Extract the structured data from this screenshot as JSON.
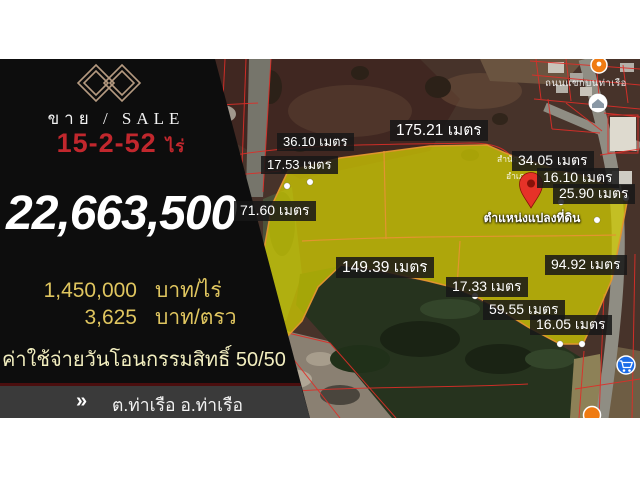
{
  "title": "Land for sale listing — Tha Ruea, Ayutthaya",
  "panel": {
    "logo_icon": "double-diamond-logo",
    "sale_line": "ขาย / SALE",
    "area_value": "15-2-52",
    "area_unit": "ไร่",
    "total_price": "22,663,500",
    "price_rows": [
      {
        "value": "1,450,000",
        "unit": "บาท/ไร่"
      },
      {
        "value": "3,625",
        "unit": "บาท/ตรว"
      }
    ],
    "transfer_note": "ค่าใช้จ่ายวันโอนกรรมสิทธิ์ 50/50",
    "location_chevron": "»",
    "location": "ต.ท่าเรือ อ.ท่าเรือ จ.อยุธยา",
    "colors": {
      "accent_red": "#c1272d",
      "gold": "#dfc55f",
      "pale_yellow": "#f2eebf",
      "panel_black": "#0d0d0d",
      "bar_gray": "#3a3a3a",
      "logo_tan": "#b59a80"
    }
  },
  "map": {
    "plot_position_label": "ตำแหน่งแปลงที่ดิน",
    "road_label": "ถนนแขกบนท่าเรือ",
    "poi_text_1": "สำนัก",
    "poi_text_2": "อำเภอ",
    "icons": {
      "pin": "location-pin",
      "cart": "shopping-cart",
      "top_poi": "orange-place-marker",
      "white_poi": "place-circle",
      "bottom_poi": "orange-place-marker"
    },
    "colors": {
      "highlight_yellow": "#d7d200",
      "boundary_orange": "#e0952f",
      "parcel_red": "#dd2e28"
    },
    "measurements": [
      {
        "text": "36.10 เมตร",
        "left": 277,
        "top": 133,
        "size": "sm"
      },
      {
        "text": "17.53 เมตร",
        "left": 261,
        "top": 156,
        "size": "sm"
      },
      {
        "text": "175.21 เมตร",
        "left": 390,
        "top": 120,
        "size": "lg"
      },
      {
        "text": "34.05 เมตร",
        "left": 512,
        "top": 151,
        "size": "md"
      },
      {
        "text": "16.10 เมตร",
        "left": 537,
        "top": 168,
        "size": "md"
      },
      {
        "text": "25.90 เมตร",
        "left": 553,
        "top": 184,
        "size": "md"
      },
      {
        "text": "71.60 เมตร",
        "left": 234,
        "top": 201,
        "size": "md"
      },
      {
        "text": "149.39 เมตร",
        "left": 336,
        "top": 257,
        "size": "lg"
      },
      {
        "text": "17.33 เมตร",
        "left": 446,
        "top": 277,
        "size": "md"
      },
      {
        "text": "94.92 เมตร",
        "left": 545,
        "top": 255,
        "size": "md"
      },
      {
        "text": "59.55 เมตร",
        "left": 483,
        "top": 300,
        "size": "md"
      },
      {
        "text": "16.05 เมตร",
        "left": 530,
        "top": 315,
        "size": "md"
      }
    ]
  }
}
